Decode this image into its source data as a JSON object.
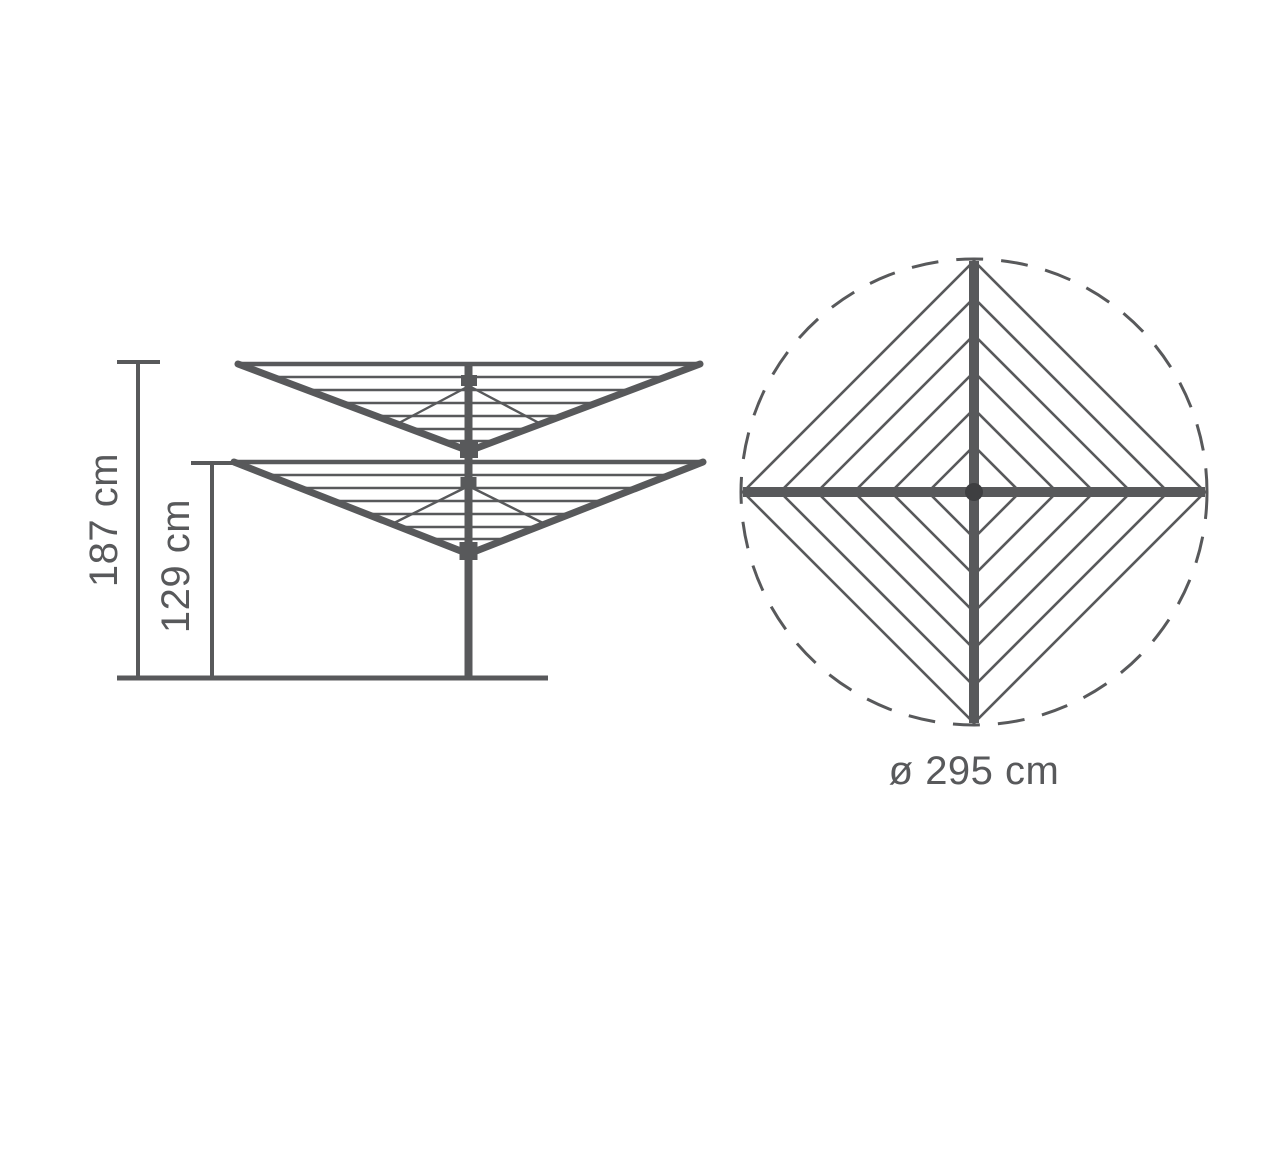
{
  "side_view": {
    "total_height_label": "187 cm",
    "lowered_height_label": "129 cm"
  },
  "top_view": {
    "diameter_label": "ø 295 cm"
  },
  "colors": {
    "line": "#58595b",
    "hub_dot": "#3e3f41",
    "background": "#ffffff"
  }
}
